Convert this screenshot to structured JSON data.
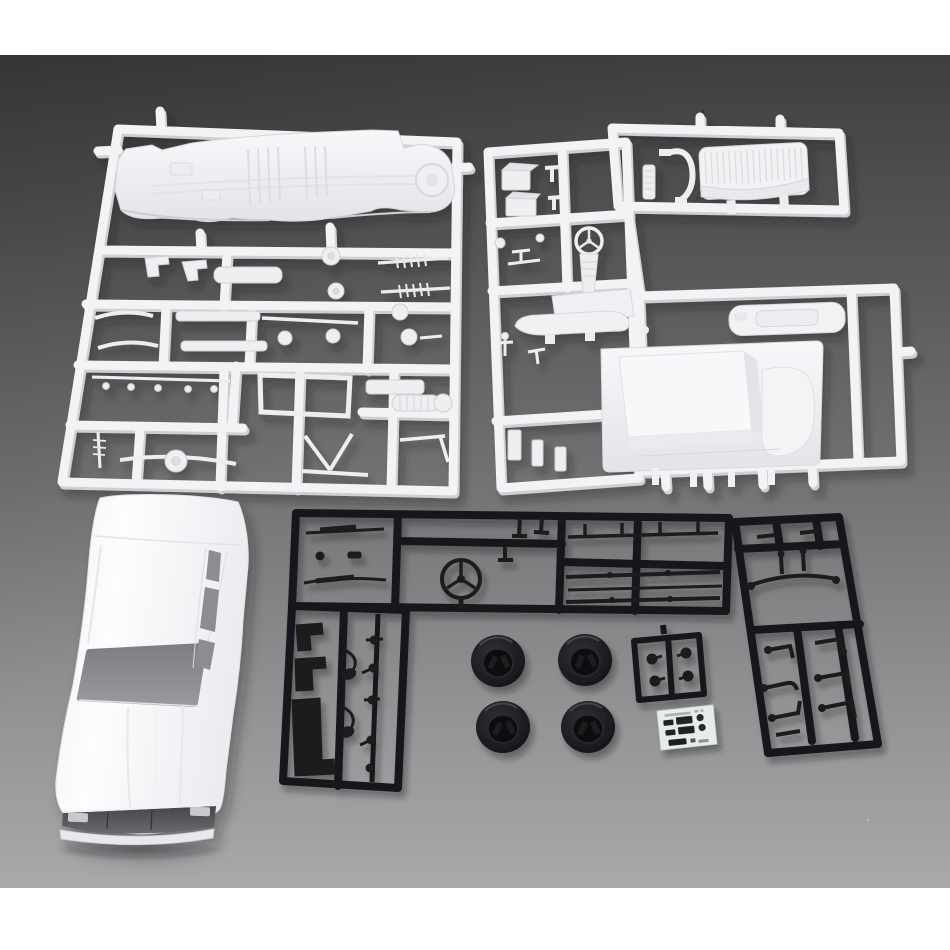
{
  "image": {
    "kind": "product photograph",
    "description": "Unassembled plastic model car kit laid out on a gray studio background: two white part sprues, a white sedan body shell, two large black part sprues, a small black mirror sprue, four black tires and a small decal sheet",
    "background": {
      "frame_band_color": "#ffffff",
      "surface_top_color": "#414143",
      "surface_bottom_color": "#a9a9ab"
    }
  },
  "counts": {
    "white_sprues": 2,
    "black_sprues": 3,
    "tires": 4,
    "decal_sheets": 1,
    "body_shells": 1
  },
  "items": [
    {
      "id": "chassis-sprue",
      "label": "White sprue A - chassis floor pan, exhaust, shocks, axles and suspension parts",
      "color": "#f3f3f5"
    },
    {
      "id": "interior-sprue",
      "label": "White sprue B - interior tub, bench seat, dashboard, steering wheel and engine parts",
      "color": "#f3f3f5"
    },
    {
      "id": "body-shell",
      "label": "White car body shell with open windshield and side windows",
      "color": "#fbfbfd"
    },
    {
      "id": "black-chassis-sprue",
      "label": "Black sprue C - steering wheel, wiper arms, trim strips and small fittings",
      "color": "#1a1a1d"
    },
    {
      "id": "black-suspension-sprue",
      "label": "Black sprue D - suspension arms, sway bar and linkage rods",
      "color": "#1a1a1d"
    },
    {
      "id": "mirror-sprue",
      "label": "Small black sprue with four door-mirror parts",
      "color": "#1a1a1d"
    },
    {
      "id": "tire-set",
      "label": "Four black tires with hollow wheel backs",
      "color": "#17171a"
    },
    {
      "id": "decal-sheet",
      "label": "Small decal sheet with black license plates and round emblems",
      "color": "#e6ece7"
    }
  ]
}
